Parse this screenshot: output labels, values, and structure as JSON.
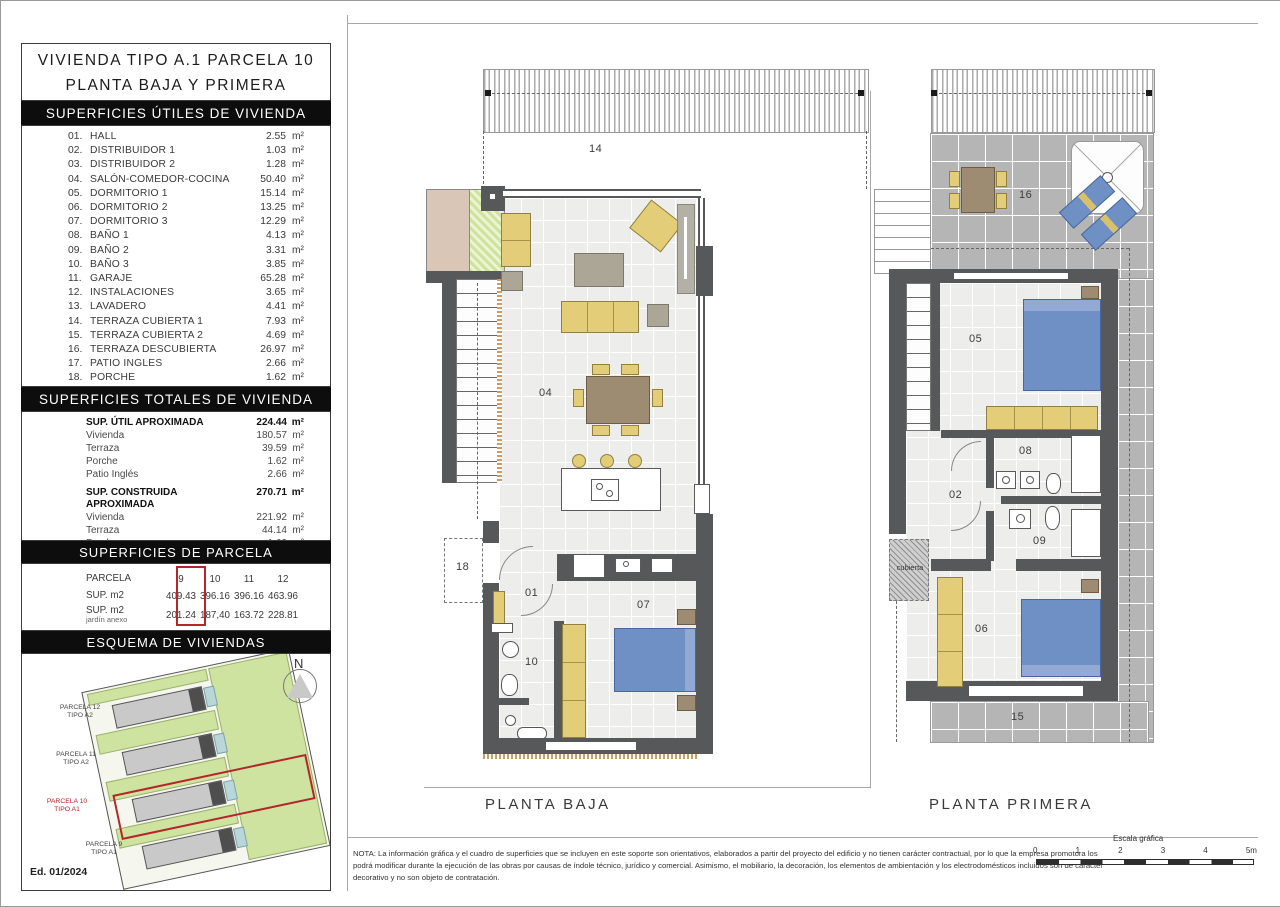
{
  "sidebar": {
    "title_line1": "VIVIENDA TIPO A.1 PARCELA 10",
    "title_line2": "PLANTA BAJA Y PRIMERA",
    "utiles": {
      "heading": "SUPERFICIES ÚTILES DE VIVIENDA",
      "unit": "m²",
      "items": [
        {
          "num": "01.",
          "label": "HALL",
          "value": "2.55"
        },
        {
          "num": "02.",
          "label": "DISTRIBUIDOR 1",
          "value": "1.03"
        },
        {
          "num": "03.",
          "label": "DISTRIBUIDOR 2",
          "value": "1.28"
        },
        {
          "num": "04.",
          "label": "SALÓN-COMEDOR-COCINA",
          "value": "50.40"
        },
        {
          "num": "05.",
          "label": "DORMITORIO 1",
          "value": "15.14"
        },
        {
          "num": "06.",
          "label": "DORMITORIO 2",
          "value": "13.25"
        },
        {
          "num": "07.",
          "label": "DORMITORIO 3",
          "value": "12.29"
        },
        {
          "num": "08.",
          "label": "BAÑO 1",
          "value": "4.13"
        },
        {
          "num": "09.",
          "label": "BAÑO 2",
          "value": "3.31"
        },
        {
          "num": "10.",
          "label": "BAÑO 3",
          "value": "3.85"
        },
        {
          "num": "11.",
          "label": "GARAJE",
          "value": "65.28"
        },
        {
          "num": "12.",
          "label": "INSTALACIONES",
          "value": "3.65"
        },
        {
          "num": "13.",
          "label": "LAVADERO",
          "value": "4.41"
        },
        {
          "num": "14.",
          "label": "TERRAZA CUBIERTA 1",
          "value": "7.93"
        },
        {
          "num": "15.",
          "label": "TERRAZA CUBIERTA 2",
          "value": "4.69"
        },
        {
          "num": "16.",
          "label": "TERRAZA DESCUBIERTA",
          "value": "26.97"
        },
        {
          "num": "17.",
          "label": "PATIO INGLES",
          "value": "2.66"
        },
        {
          "num": "18.",
          "label": "PORCHE",
          "value": "1.62"
        }
      ]
    },
    "totales": {
      "heading": "SUPERFICIES TOTALES DE VIVIENDA",
      "unit": "m²",
      "groups": [
        {
          "title": "SUP. ÚTIL APROXIMADA",
          "total": "224.44",
          "rows": [
            {
              "label": "Vivienda",
              "value": "180.57"
            },
            {
              "label": "Terraza",
              "value": "39.59"
            },
            {
              "label": "Porche",
              "value": "1.62"
            },
            {
              "label": "Patio Inglés",
              "value": "2.66"
            }
          ]
        },
        {
          "title": "SUP. CONSTRUIDA APROXIMADA",
          "total": "270.71",
          "rows": [
            {
              "label": "Vivienda",
              "value": "221.92"
            },
            {
              "label": "Terraza",
              "value": "44.14"
            },
            {
              "label": "Porche",
              "value": "1.62"
            },
            {
              "label": "Patio inglés",
              "value": "3.03"
            }
          ]
        }
      ]
    },
    "parcela": {
      "heading": "SUPERFICIES DE PARCELA",
      "row1_label": "PARCELA",
      "row2_label": "SUP. m2",
      "row3_label_line1": "SUP. m2",
      "row3_label_line2": "jardín anexo",
      "columns": [
        "9",
        "10",
        "11",
        "12"
      ],
      "sup": [
        "409.43",
        "396.16",
        "396.16",
        "463.96"
      ],
      "jardin": [
        "201.24",
        "187,40",
        "163.72",
        "228.81"
      ],
      "highlighted_column": "10"
    },
    "esquema": {
      "heading": "ESQUEMA DE VIVIENDAS",
      "north": "N",
      "parcels": [
        {
          "line1": "PARCELA 12",
          "line2": "TIPO A2"
        },
        {
          "line1": "PARCELA 11",
          "line2": "TIPO A2"
        },
        {
          "line1": "PARCELA 10",
          "line2": "TIPO A1"
        },
        {
          "line1": "PARCELA 9",
          "line2": "TIPO A1"
        }
      ],
      "edition": "Ed. 01/2024"
    }
  },
  "plans": {
    "baja": {
      "caption": "PLANTA BAJA",
      "labels": {
        "terraza14": "14",
        "salon": "04",
        "porche": "18",
        "hall": "01",
        "bano": "10",
        "dormitorio": "07"
      }
    },
    "primera": {
      "caption": "PLANTA PRIMERA",
      "labels": {
        "terraza16": "16",
        "dormitorio1": "05",
        "bano1": "08",
        "distribuidor": "02",
        "bano2": "09",
        "dormitorio2": "06",
        "terraza15": "15",
        "cubierta": "cubierta"
      }
    }
  },
  "footer": {
    "nota": "NOTA: La información gráfica y el cuadro de superficies que se incluyen en este soporte son orientativos, elaborados a partir del proyecto del edificio y no tienen carácter contractual, por lo que la empresa promotora los podrá modificar durante la ejecución de las obras por causas de índole técnico, jurídico y comercial. Asimismo, el mobiliario, la decoración, los elementos de ambientación y los electrodomésticos incluidos son de carácter decorativo y no son objeto de contratación.",
    "escala_label": "Escala gráfica",
    "escala_ticks": [
      "0",
      "1",
      "2",
      "3",
      "4",
      "5m"
    ]
  },
  "colors": {
    "highlight_red": "#b5262a",
    "wall_dark": "#57585a",
    "furniture_yellow": "#e3cd79",
    "bed_blue": "#6e90c5",
    "terrace_tile": "#b5b5b6",
    "floor_light": "#edeeec",
    "garden_green": "#cfe3a0",
    "planter_beige": "#d9c6b6",
    "header_black": "#0d0d0d"
  }
}
